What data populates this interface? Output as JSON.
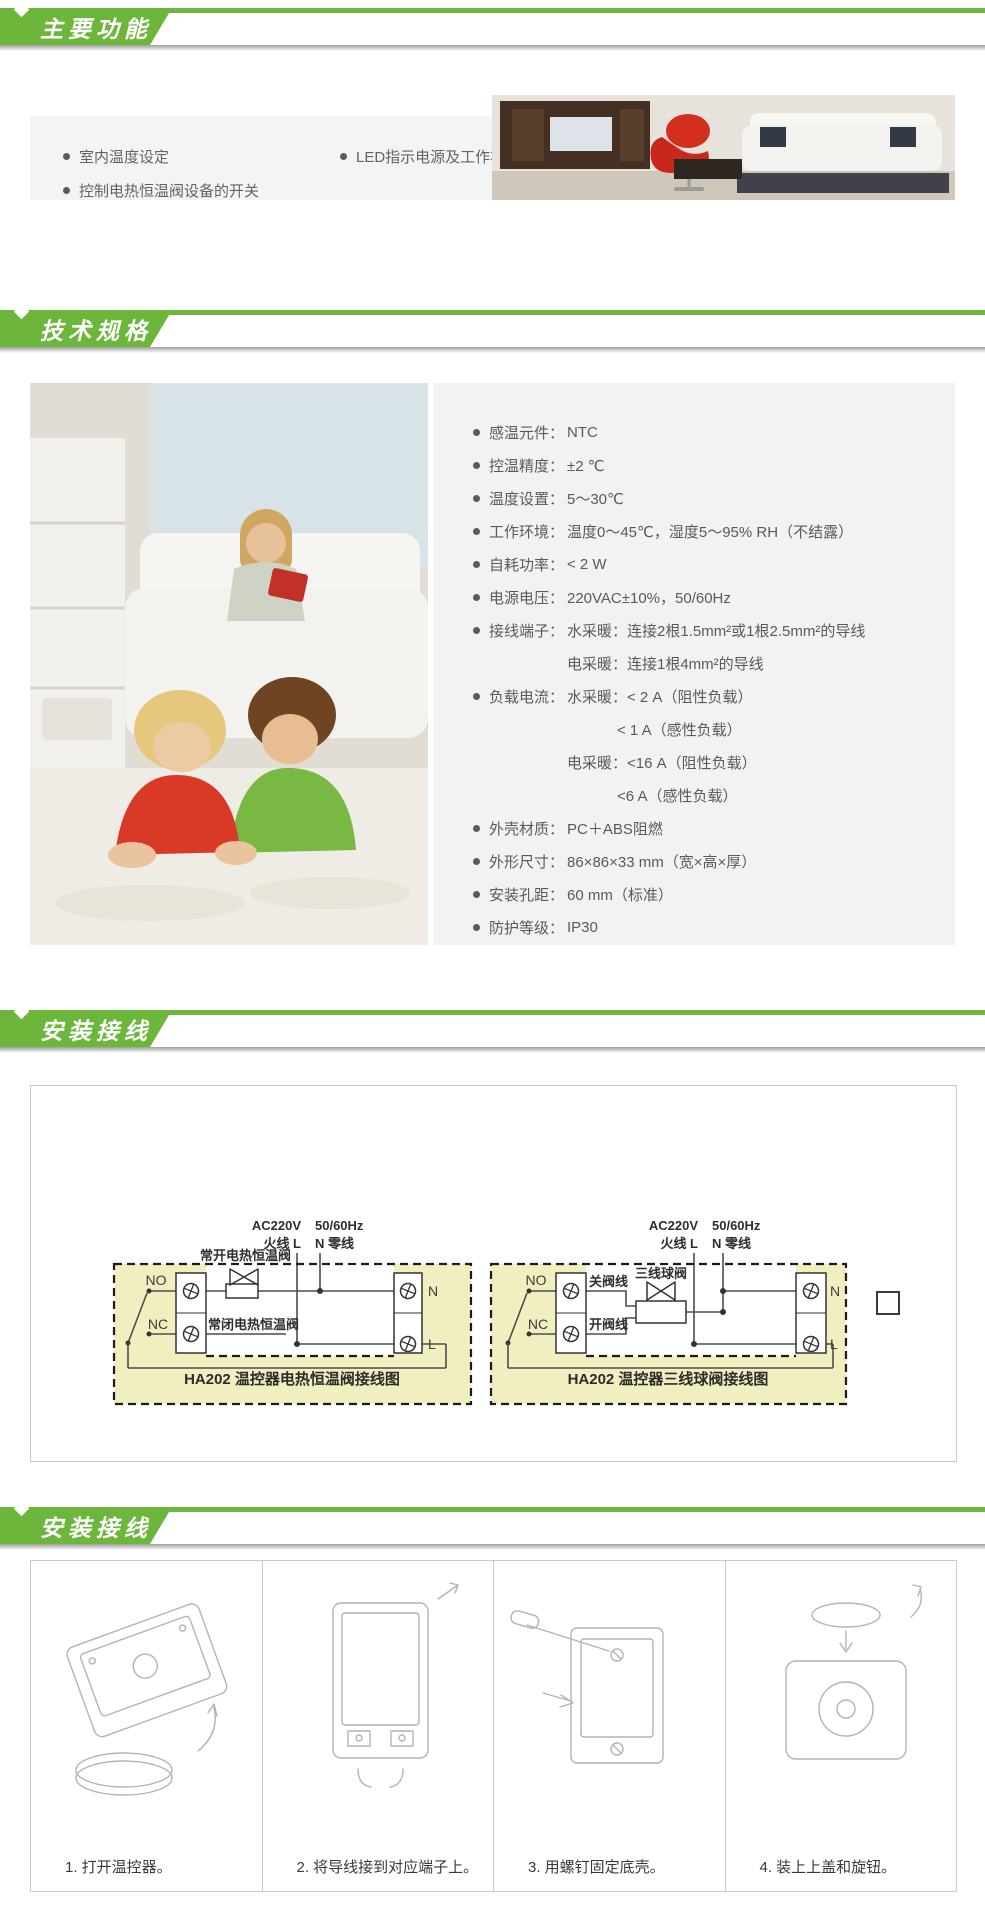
{
  "colors": {
    "accent_green": "#6cb63c",
    "features_bg": "#f4f4f4",
    "specs_bg": "#f2f2f2",
    "diagram_bg": "#f1eebf"
  },
  "banners": [
    {
      "title": "主要功能"
    },
    {
      "title": "技术规格"
    },
    {
      "title": "安装接线"
    },
    {
      "title": "安装接线"
    }
  ],
  "features": {
    "left": [
      "室内温度设定",
      "控制电热恒温阀设备的开关"
    ],
    "right": [
      "LED指示电源及工作状态"
    ]
  },
  "specs": {
    "rows": [
      {
        "type": "main",
        "label": "感温元件：",
        "text": "NTC"
      },
      {
        "type": "main",
        "label": "控温精度：",
        "text": "±2 ℃"
      },
      {
        "type": "main",
        "label": "温度设置：",
        "text": "5～30℃"
      },
      {
        "type": "main",
        "label": "工作环境：",
        "text": "温度0～45℃，湿度5～95% RH（不结露）"
      },
      {
        "type": "main",
        "label": "自耗功率：",
        "text": "< 2 W"
      },
      {
        "type": "main",
        "label": "电源电压：",
        "text": "220VAC±10%，50/60Hz"
      },
      {
        "type": "main",
        "label": "接线端子：",
        "text": "水采暖：连接2根1.5mm²或1根2.5mm²的导线"
      },
      {
        "type": "cont",
        "text": "电采暖：连接1根4mm²的导线"
      },
      {
        "type": "main",
        "label": "负载电流：",
        "text": "水采暖：< 2 A（阻性负载）"
      },
      {
        "type": "cont2",
        "text": "< 1  A（感性负载）"
      },
      {
        "type": "cont",
        "text": "电采暖：<16 A（阻性负载）"
      },
      {
        "type": "cont2",
        "text": "<6  A（感性负载）"
      },
      {
        "type": "main",
        "label": "外壳材质：",
        "text": "PC＋ABS阻燃"
      },
      {
        "type": "main",
        "label": "外形尺寸：",
        "text": "86×86×33 mm（宽×高×厚）"
      },
      {
        "type": "main",
        "label": "安装孔距：",
        "text": "60 mm（标准）"
      },
      {
        "type": "main",
        "label": "防护等级：",
        "text": "IP30"
      }
    ]
  },
  "diagrams": {
    "left": {
      "ac": "AC220V",
      "freq": "50/60Hz",
      "live": "火线 L",
      "neutral": "N 零线",
      "no": "NO",
      "nc": "NC",
      "n": "N",
      "l": "L",
      "valve_open_label": "常开电热恒温阀",
      "valve_closed_label": "常闭电热恒温阀",
      "caption": "HA202 温控器电热恒温阀接线图"
    },
    "right": {
      "ac": "AC220V",
      "freq": "50/60Hz",
      "live": "火线 L",
      "neutral": "N 零线",
      "no": "NO",
      "nc": "NC",
      "n": "N",
      "l": "L",
      "valve_label": "三线球阀",
      "close_wire_label": "关阀线",
      "open_wire_label": "开阀线",
      "caption": "HA202 温控器三线球阀接线图"
    }
  },
  "steps": [
    {
      "caption": "1. 打开温控器。"
    },
    {
      "caption": "2. 将导线接到对应端子上。"
    },
    {
      "caption": "3. 用螺钉固定底壳。"
    },
    {
      "caption": "4. 装上上盖和旋钮。"
    }
  ]
}
